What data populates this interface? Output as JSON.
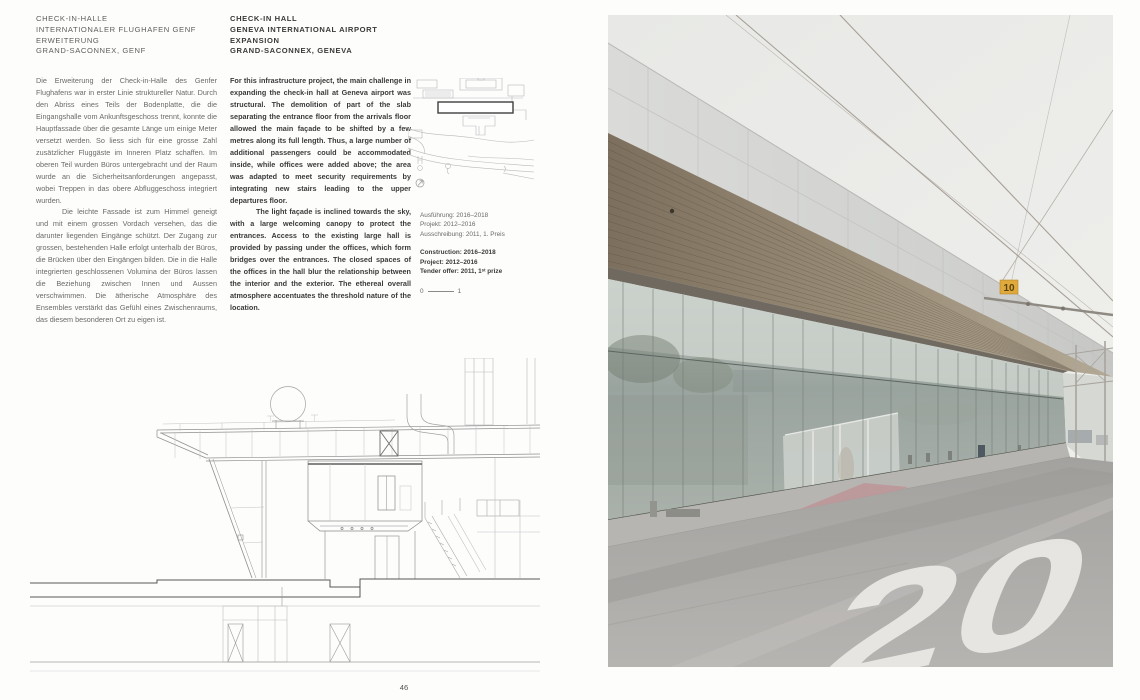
{
  "doc": {
    "page_number": "46",
    "titles": {
      "de": [
        "CHECK-IN-HALLE",
        "INTERNATIONALER FLUGHAFEN GENF",
        "ERWEITERUNG",
        "GRAND-SACONNEX, GENF"
      ],
      "en": [
        "CHECK-IN HALL",
        "GENEVA INTERNATIONAL AIRPORT",
        "EXPANSION",
        "GRAND-SACONNEX, GENEVA"
      ]
    },
    "body_de": {
      "p1": "Die Erweiterung der Check-in-Halle des Genfer Flughafens war in erster Linie struktureller Natur. Durch den Abriss eines Teils der Bodenplatte, die die Eingangshalle vom Ankunftsgeschoss trennt, konnte die Hauptfassade über die gesamte Länge um einige Meter versetzt werden. So liess sich für eine grosse Zahl zusätzlicher Fluggäste im Inneren Platz schaffen. Im oberen Teil wurden Büros untergebracht und der Raum wurde an die Sicherheitsanforderungen angepasst, wobei Treppen in das obere Abfluggeschoss integriert wurden.",
      "p2": "Die leichte Fassade ist zum Himmel geneigt und mit einem grossen Vordach versehen, das die darunter liegenden Eingänge schützt. Der Zugang zur grossen, bestehenden Halle erfolgt unterhalb der Büros, die Brücken über den Eingängen bilden. Die in die Halle integrierten geschlossenen Volumina der Büros lassen die Beziehung zwischen Innen und Aussen verschwimmen. Die ätherische Atmosphäre des Ensembles verstärkt das Gefühl eines Zwischenraums, das diesem besonderen Ort zu eigen ist."
    },
    "body_en": {
      "p1": "For this infrastructure project, the main challenge in expanding the check-in hall at Geneva airport was structural. The demolition of part of the slab separating the entrance floor from the arrivals floor allowed the main façade to be shifted by a few metres along its full length. Thus, a large number of additional passengers could be accommodated inside, while offices were added above; the area was adapted to meet security requirements by integrating new stairs leading to the upper departures floor.",
      "p2": "The light façade is inclined towards the sky, with a large welcoming canopy to protect the entrances. Access to the existing large hall is provided by passing under the offices, which form bridges over the entrances. The closed spaces of the offices in the hall blur the relationship between the interior and the exterior. The ethereal overall atmosphere accentuates the threshold nature of the location."
    },
    "project_meta": {
      "de": [
        "Ausführung: 2016–2018",
        "Projekt: 2012–2016",
        "Ausschreibung: 2011, 1. Preis"
      ],
      "en": [
        "Construction: 2016–2018",
        "Project: 2012–2016",
        "Tender offer: 2011, 1ˢᵗ prize"
      ]
    },
    "scale_bar": {
      "start": "0",
      "end": "1"
    },
    "photo": {
      "overhead_sign_label": "10",
      "road_marking": "20",
      "colors": {
        "sign_yellow": "#dfa93b",
        "sky": "#e9eae7",
        "soffit_wood": "#84765f",
        "fascia": "#d8d9d7",
        "glass": "#9fa8a3",
        "road": "#a9a7a4",
        "carpet_red": "#bd9598"
      }
    }
  }
}
